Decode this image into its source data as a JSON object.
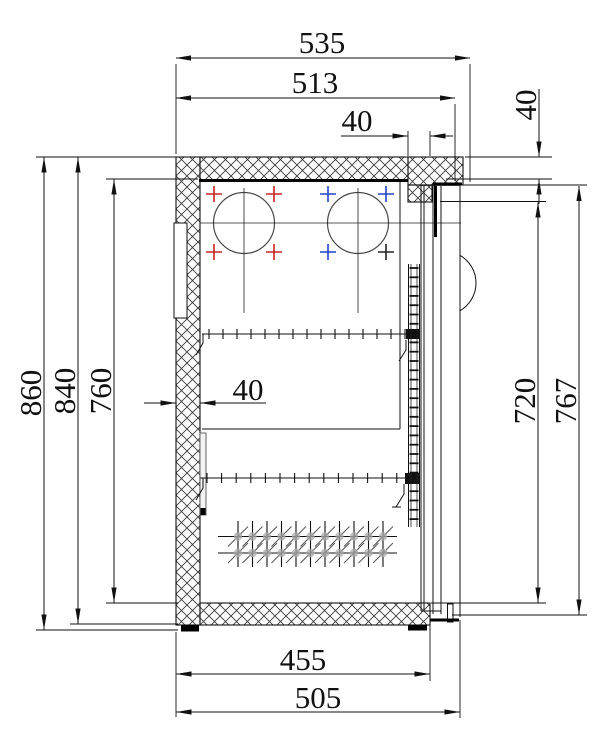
{
  "drawing": {
    "type": "technical-section-drawing",
    "dimensions": {
      "overall_depth": "535",
      "inner_depth": "513",
      "top_front_frame": "40",
      "top_frame_height": "40",
      "overall_height": "860",
      "body_height": "840",
      "interior_height": "760",
      "back_wall_thickness": "40",
      "door_opening_height": "720",
      "door_height": "767",
      "bottom_inner_depth": "455",
      "bottom_depth": "505"
    },
    "colors": {
      "line": "#111111",
      "hatch": "#3a3a3a",
      "hole_marker_red": "#cc2222",
      "hole_marker_blue": "#2244cc",
      "hole_marker_dark": "#222222"
    }
  }
}
